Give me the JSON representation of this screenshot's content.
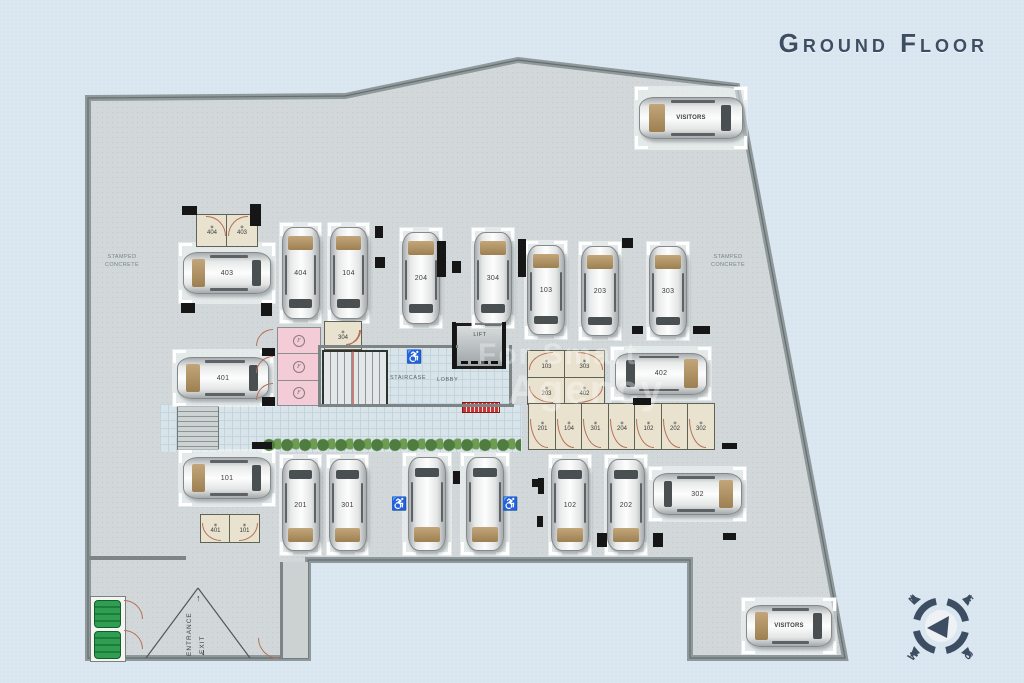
{
  "title": "Ground Floor",
  "labels": {
    "stamped_concrete_left": "STAMPED CONCRETE",
    "stamped_concrete_right": "STAMPED CONCRETE",
    "staircase": "STAIRCASE",
    "lobby": "LOBBY",
    "lift": "LIFT",
    "entrance": "ENTRANCE",
    "exit": "EXIT",
    "up_arrow": "↑",
    "down_arrow": "↓"
  },
  "watermark": {
    "line1": "For Smart",
    "line2": "Agency"
  },
  "compass": {
    "north": "N",
    "east": "E",
    "south": "S",
    "west": "W"
  },
  "colors": {
    "background": "#d9e5ef",
    "floor": "#d2d8d9",
    "boundary_wall": "#8f989a",
    "pillar": "#161616",
    "storage_room": "#e9e2cf",
    "pink_room": "#f4ccd8",
    "tile": "#d8e4e9",
    "hedge_green": "#4f7d3f",
    "car_body": "#e8eaea",
    "windshield_tan": "#b29468",
    "door_arc": "#b5705a",
    "mat_red": "#cc3333",
    "title_color": "#3d4e63",
    "generator_green": "#2f9e52",
    "accessible_blue": "#2333bb"
  },
  "site_outline_points": "88,98 345,96 518,60 737,86 845,658 690,658 690,560 308,560 308,658 88,658",
  "parking_spots": [
    {
      "id": "visitors-top",
      "label": "VISITORS",
      "x": 634,
      "y": 86,
      "w": 114,
      "h": 64,
      "tan": "left",
      "visitors": true
    },
    {
      "id": "403",
      "label": "403",
      "x": 178,
      "y": 242,
      "w": 98,
      "h": 62,
      "tan": "left"
    },
    {
      "id": "404",
      "label": "404",
      "x": 279,
      "y": 222,
      "w": 43,
      "h": 102,
      "tan": "top"
    },
    {
      "id": "104",
      "label": "104",
      "x": 327,
      "y": 222,
      "w": 43,
      "h": 102,
      "tan": "top"
    },
    {
      "id": "204",
      "label": "204",
      "x": 399,
      "y": 227,
      "w": 44,
      "h": 102,
      "tan": "top"
    },
    {
      "id": "304",
      "label": "304",
      "x": 471,
      "y": 227,
      "w": 44,
      "h": 102,
      "tan": "top"
    },
    {
      "id": "103",
      "label": "103",
      "x": 524,
      "y": 240,
      "w": 44,
      "h": 100,
      "tan": "top"
    },
    {
      "id": "203",
      "label": "203",
      "x": 578,
      "y": 241,
      "w": 44,
      "h": 100,
      "tan": "top"
    },
    {
      "id": "303",
      "label": "303",
      "x": 646,
      "y": 241,
      "w": 44,
      "h": 100,
      "tan": "top"
    },
    {
      "id": "401",
      "label": "401",
      "x": 172,
      "y": 349,
      "w": 102,
      "h": 58,
      "tan": "left"
    },
    {
      "id": "402",
      "label": "402",
      "x": 610,
      "y": 346,
      "w": 102,
      "h": 55,
      "tan": "right"
    },
    {
      "id": "101",
      "label": "101",
      "x": 178,
      "y": 449,
      "w": 98,
      "h": 58,
      "tan": "left"
    },
    {
      "id": "201",
      "label": "201",
      "x": 279,
      "y": 454,
      "w": 43,
      "h": 102,
      "tan": "bottom"
    },
    {
      "id": "301",
      "label": "301",
      "x": 326,
      "y": 454,
      "w": 43,
      "h": 102,
      "tan": "bottom"
    },
    {
      "id": "accessible-1",
      "label": "",
      "x": 402,
      "y": 452,
      "w": 50,
      "h": 104,
      "tan": "bottom"
    },
    {
      "id": "accessible-2",
      "label": "",
      "x": 460,
      "y": 452,
      "w": 50,
      "h": 104,
      "tan": "bottom"
    },
    {
      "id": "102",
      "label": "102",
      "x": 548,
      "y": 454,
      "w": 44,
      "h": 102,
      "tan": "bottom"
    },
    {
      "id": "202",
      "label": "202",
      "x": 604,
      "y": 454,
      "w": 44,
      "h": 102,
      "tan": "bottom"
    },
    {
      "id": "302",
      "label": "302",
      "x": 648,
      "y": 466,
      "w": 99,
      "h": 56,
      "tan": "right"
    },
    {
      "id": "visitors-bottom",
      "label": "VISITORS",
      "x": 741,
      "y": 597,
      "w": 96,
      "h": 58,
      "tan": "left",
      "visitors": true
    }
  ],
  "storage_rooms": [
    {
      "id": "st-404",
      "label": "404",
      "x": 196,
      "y": 214,
      "w": 30,
      "h": 31,
      "door": "tr"
    },
    {
      "id": "st-403",
      "label": "403",
      "x": 226,
      "y": 214,
      "w": 30,
      "h": 31,
      "door": "tl"
    },
    {
      "id": "st-304",
      "label": "304",
      "x": 324,
      "y": 321,
      "w": 36,
      "h": 27,
      "door": "br"
    },
    {
      "id": "st-103",
      "label": "103",
      "x": 527,
      "y": 350,
      "w": 37,
      "h": 27,
      "door": "tl"
    },
    {
      "id": "st-303",
      "label": "303",
      "x": 564,
      "y": 350,
      "w": 39,
      "h": 27,
      "door": "tr"
    },
    {
      "id": "st-203",
      "label": "203",
      "x": 527,
      "y": 377,
      "w": 37,
      "h": 26,
      "door": "bl"
    },
    {
      "id": "st-402",
      "label": "402",
      "x": 564,
      "y": 377,
      "w": 39,
      "h": 26,
      "door": "br"
    },
    {
      "id": "st-201",
      "label": "201",
      "x": 528,
      "y": 403,
      "w": 27,
      "h": 45,
      "door": "bl"
    },
    {
      "id": "st-104",
      "label": "104",
      "x": 555,
      "y": 403,
      "w": 26,
      "h": 45,
      "door": "bl"
    },
    {
      "id": "st-301",
      "label": "301",
      "x": 581,
      "y": 403,
      "w": 27,
      "h": 45,
      "door": "bl"
    },
    {
      "id": "st-204",
      "label": "204",
      "x": 608,
      "y": 403,
      "w": 26,
      "h": 45,
      "door": "bl"
    },
    {
      "id": "st-102",
      "label": "102",
      "x": 634,
      "y": 403,
      "w": 27,
      "h": 45,
      "door": "bl"
    },
    {
      "id": "st-202",
      "label": "202",
      "x": 661,
      "y": 403,
      "w": 26,
      "h": 45,
      "door": "bl"
    },
    {
      "id": "st-302",
      "label": "302",
      "x": 687,
      "y": 403,
      "w": 26,
      "h": 45,
      "door": "bl"
    },
    {
      "id": "st-401b",
      "label": "401",
      "x": 200,
      "y": 514,
      "w": 29,
      "h": 27,
      "door": "bl"
    },
    {
      "id": "st-101b",
      "label": "101",
      "x": 229,
      "y": 514,
      "w": 29,
      "h": 27,
      "door": "br"
    }
  ],
  "pink_rooms": [
    {
      "label": "F",
      "x": 277,
      "y": 327,
      "w": 42,
      "h": 25
    },
    {
      "label": "F",
      "x": 277,
      "y": 353,
      "w": 42,
      "h": 26
    },
    {
      "label": "F",
      "x": 277,
      "y": 380,
      "w": 42,
      "h": 24
    }
  ],
  "structure": {
    "tile_areas": [
      [
        318,
        347,
        194,
        60
      ],
      [
        160,
        404,
        362,
        48
      ]
    ],
    "pillars": [
      [
        182,
        206,
        15,
        9
      ],
      [
        250,
        204,
        11,
        22
      ],
      [
        181,
        303,
        14,
        10
      ],
      [
        261,
        303,
        11,
        13
      ],
      [
        375,
        226,
        8,
        12
      ],
      [
        375,
        257,
        10,
        11
      ],
      [
        452,
        261,
        9,
        12
      ],
      [
        437,
        241,
        9,
        36
      ],
      [
        518,
        239,
        8,
        38
      ],
      [
        622,
        238,
        11,
        10
      ],
      [
        632,
        326,
        11,
        8
      ],
      [
        693,
        326,
        17,
        8
      ],
      [
        262,
        348,
        13,
        8
      ],
      [
        262,
        397,
        13,
        9
      ],
      [
        633,
        398,
        18,
        7
      ],
      [
        538,
        478,
        6,
        16
      ],
      [
        453,
        471,
        7,
        13
      ],
      [
        532,
        479,
        8,
        8
      ],
      [
        537,
        516,
        6,
        11
      ],
      [
        597,
        533,
        10,
        14
      ],
      [
        653,
        533,
        10,
        14
      ],
      [
        722,
        443,
        15,
        6
      ],
      [
        723,
        533,
        13,
        7
      ],
      [
        252,
        442,
        20,
        7
      ],
      [
        452,
        322,
        4,
        47
      ],
      [
        502,
        322,
        4,
        47
      ]
    ],
    "thin_walls": [
      [
        318,
        345,
        140,
        3
      ],
      [
        318,
        345,
        3,
        62
      ],
      [
        509,
        345,
        3,
        62
      ],
      [
        318,
        404,
        196,
        3
      ],
      [
        88,
        556,
        98,
        4
      ],
      [
        280,
        562,
        3,
        96
      ]
    ],
    "door_arcs": [
      {
        "x": 256,
        "y": 329,
        "s": 16,
        "c": "tl"
      },
      {
        "x": 256,
        "y": 356,
        "s": 16,
        "c": "tl"
      },
      {
        "x": 256,
        "y": 383,
        "s": 16,
        "c": "tl"
      },
      {
        "x": 346,
        "y": 330,
        "s": 14,
        "c": "br"
      },
      {
        "x": 258,
        "y": 638,
        "s": 20,
        "c": "bl"
      },
      {
        "x": 124,
        "y": 600,
        "s": 18,
        "c": "tr"
      },
      {
        "x": 124,
        "y": 630,
        "s": 18,
        "c": "tr"
      }
    ],
    "accessible_icons": [
      [
        406,
        350
      ],
      [
        391,
        497
      ],
      [
        502,
        497
      ]
    ],
    "entrance_ramp_lines": [
      [
        198,
        588,
        146,
        658
      ],
      [
        198,
        588,
        250,
        658
      ]
    ],
    "stair_diagonals": [
      [
        324,
        352,
        386,
        403
      ],
      [
        386,
        352,
        324,
        403
      ]
    ],
    "generator_units": [
      [
        600
      ],
      [
        631
      ]
    ]
  }
}
